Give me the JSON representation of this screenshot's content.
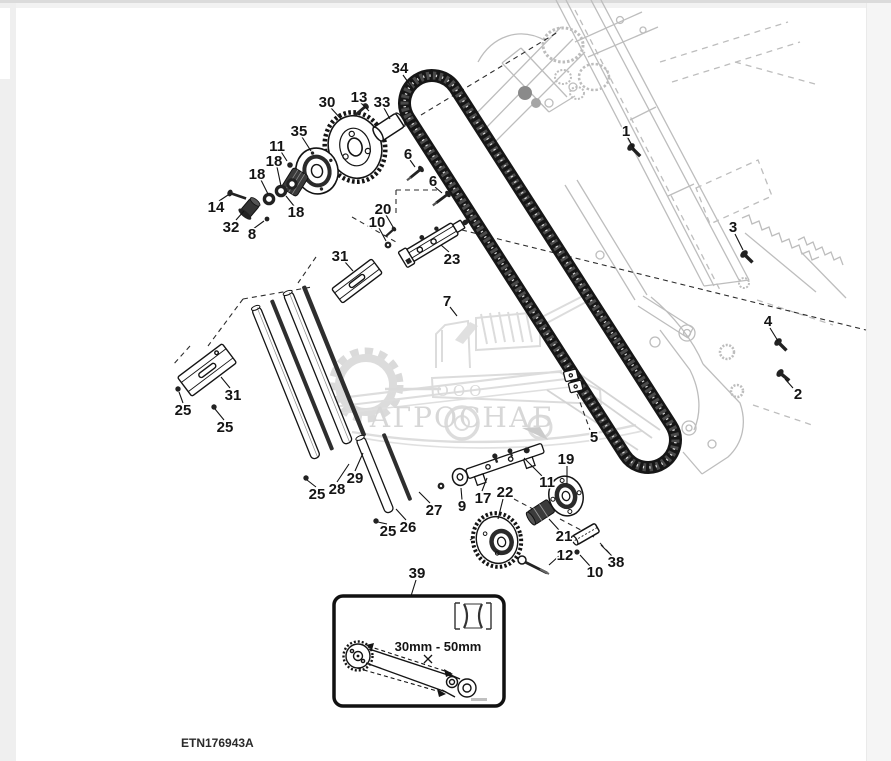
{
  "page": {
    "drawing_code": "ETN176943A",
    "background": "#ffffff",
    "margin_color": "#efefef"
  },
  "watermark": {
    "company_prefix": "ООО",
    "company_name": "АГРОСНАБ",
    "color": "#c0c0c0"
  },
  "inset": {
    "range_text": "30mm - 50mm"
  },
  "diagram": {
    "ink_color": "#141414",
    "frame_color": "#bdbdbd",
    "callouts": [
      {
        "n": "1",
        "x": 626,
        "y": 131
      },
      {
        "n": "2",
        "x": 798,
        "y": 394
      },
      {
        "n": "3",
        "x": 733,
        "y": 227
      },
      {
        "n": "4",
        "x": 768,
        "y": 321
      },
      {
        "n": "5",
        "x": 594,
        "y": 437
      },
      {
        "n": "6",
        "x": 408,
        "y": 154
      },
      {
        "n": "6",
        "x": 433,
        "y": 181
      },
      {
        "n": "7",
        "x": 447,
        "y": 301
      },
      {
        "n": "8",
        "x": 252,
        "y": 234
      },
      {
        "n": "9",
        "x": 462,
        "y": 506
      },
      {
        "n": "10",
        "x": 377,
        "y": 222
      },
      {
        "n": "10",
        "x": 595,
        "y": 572
      },
      {
        "n": "11",
        "x": 277,
        "y": 146
      },
      {
        "n": "11",
        "x": 547,
        "y": 482
      },
      {
        "n": "12",
        "x": 565,
        "y": 555
      },
      {
        "n": "13",
        "x": 359,
        "y": 97
      },
      {
        "n": "14",
        "x": 216,
        "y": 207
      },
      {
        "n": "17",
        "x": 483,
        "y": 498
      },
      {
        "n": "18",
        "x": 257,
        "y": 174
      },
      {
        "n": "18",
        "x": 274,
        "y": 161
      },
      {
        "n": "18",
        "x": 296,
        "y": 212
      },
      {
        "n": "19",
        "x": 566,
        "y": 459
      },
      {
        "n": "20",
        "x": 383,
        "y": 209
      },
      {
        "n": "21",
        "x": 564,
        "y": 536
      },
      {
        "n": "22",
        "x": 505,
        "y": 492
      },
      {
        "n": "23",
        "x": 452,
        "y": 259
      },
      {
        "n": "25",
        "x": 183,
        "y": 410
      },
      {
        "n": "25",
        "x": 225,
        "y": 427
      },
      {
        "n": "25",
        "x": 317,
        "y": 494
      },
      {
        "n": "25",
        "x": 388,
        "y": 531
      },
      {
        "n": "26",
        "x": 408,
        "y": 527
      },
      {
        "n": "27",
        "x": 434,
        "y": 510
      },
      {
        "n": "28",
        "x": 337,
        "y": 489
      },
      {
        "n": "29",
        "x": 355,
        "y": 478
      },
      {
        "n": "30",
        "x": 327,
        "y": 102
      },
      {
        "n": "31",
        "x": 340,
        "y": 256
      },
      {
        "n": "31",
        "x": 233,
        "y": 395
      },
      {
        "n": "32",
        "x": 231,
        "y": 227
      },
      {
        "n": "33",
        "x": 382,
        "y": 102
      },
      {
        "n": "34",
        "x": 400,
        "y": 68
      },
      {
        "n": "35",
        "x": 299,
        "y": 131
      },
      {
        "n": "38",
        "x": 616,
        "y": 562
      },
      {
        "n": "39",
        "x": 417,
        "y": 573
      }
    ]
  }
}
